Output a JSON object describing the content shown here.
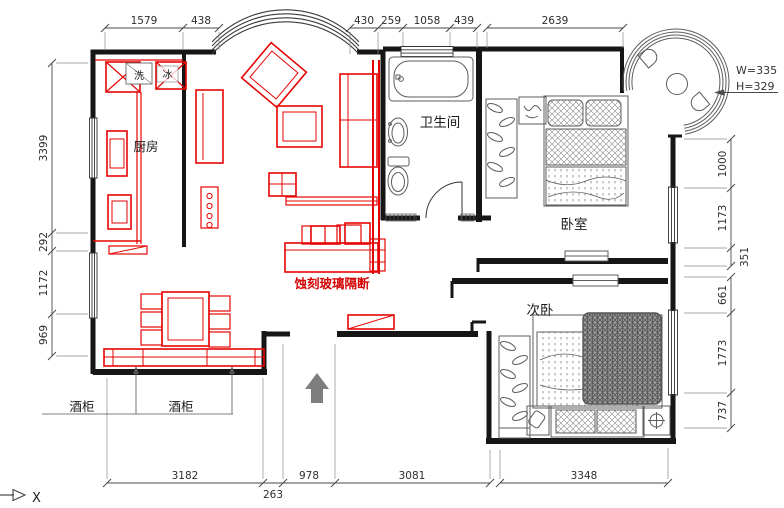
{
  "drawing": {
    "type": "apartment-floor-plan",
    "rooms": {
      "kitchen": "厨房",
      "bathroom": "卫生间",
      "master_bedroom": "卧室",
      "second_bedroom": "次卧"
    },
    "annotations": {
      "wash": "洗",
      "fridge": "冰",
      "wine_cabinet_1": "酒柜",
      "wine_cabinet_2": "酒柜",
      "glass_partition": "蚀刻玻璃隔断",
      "window_width": "W=335",
      "window_height": "H=329",
      "axis_label": "X"
    },
    "dimensions": {
      "top": [
        "1579",
        "438",
        "430",
        "259",
        "1058",
        "439",
        "2639"
      ],
      "bottom": [
        "3182",
        "978",
        "3081",
        "3348"
      ],
      "bottom_offset": "263",
      "left": [
        "3399",
        "292",
        "1172",
        "969"
      ],
      "right": [
        "1000",
        "1173",
        "351",
        "661",
        "1773",
        "737"
      ]
    },
    "colors": {
      "background": "#ffffff",
      "walls": "#161616",
      "furniture_detail": "#5c5c5c",
      "red_overlay": "#e60505",
      "red_label": "#d40404",
      "dimension_lines": "#4a4a4a",
      "north_arrow": "#7e7e7e"
    }
  }
}
